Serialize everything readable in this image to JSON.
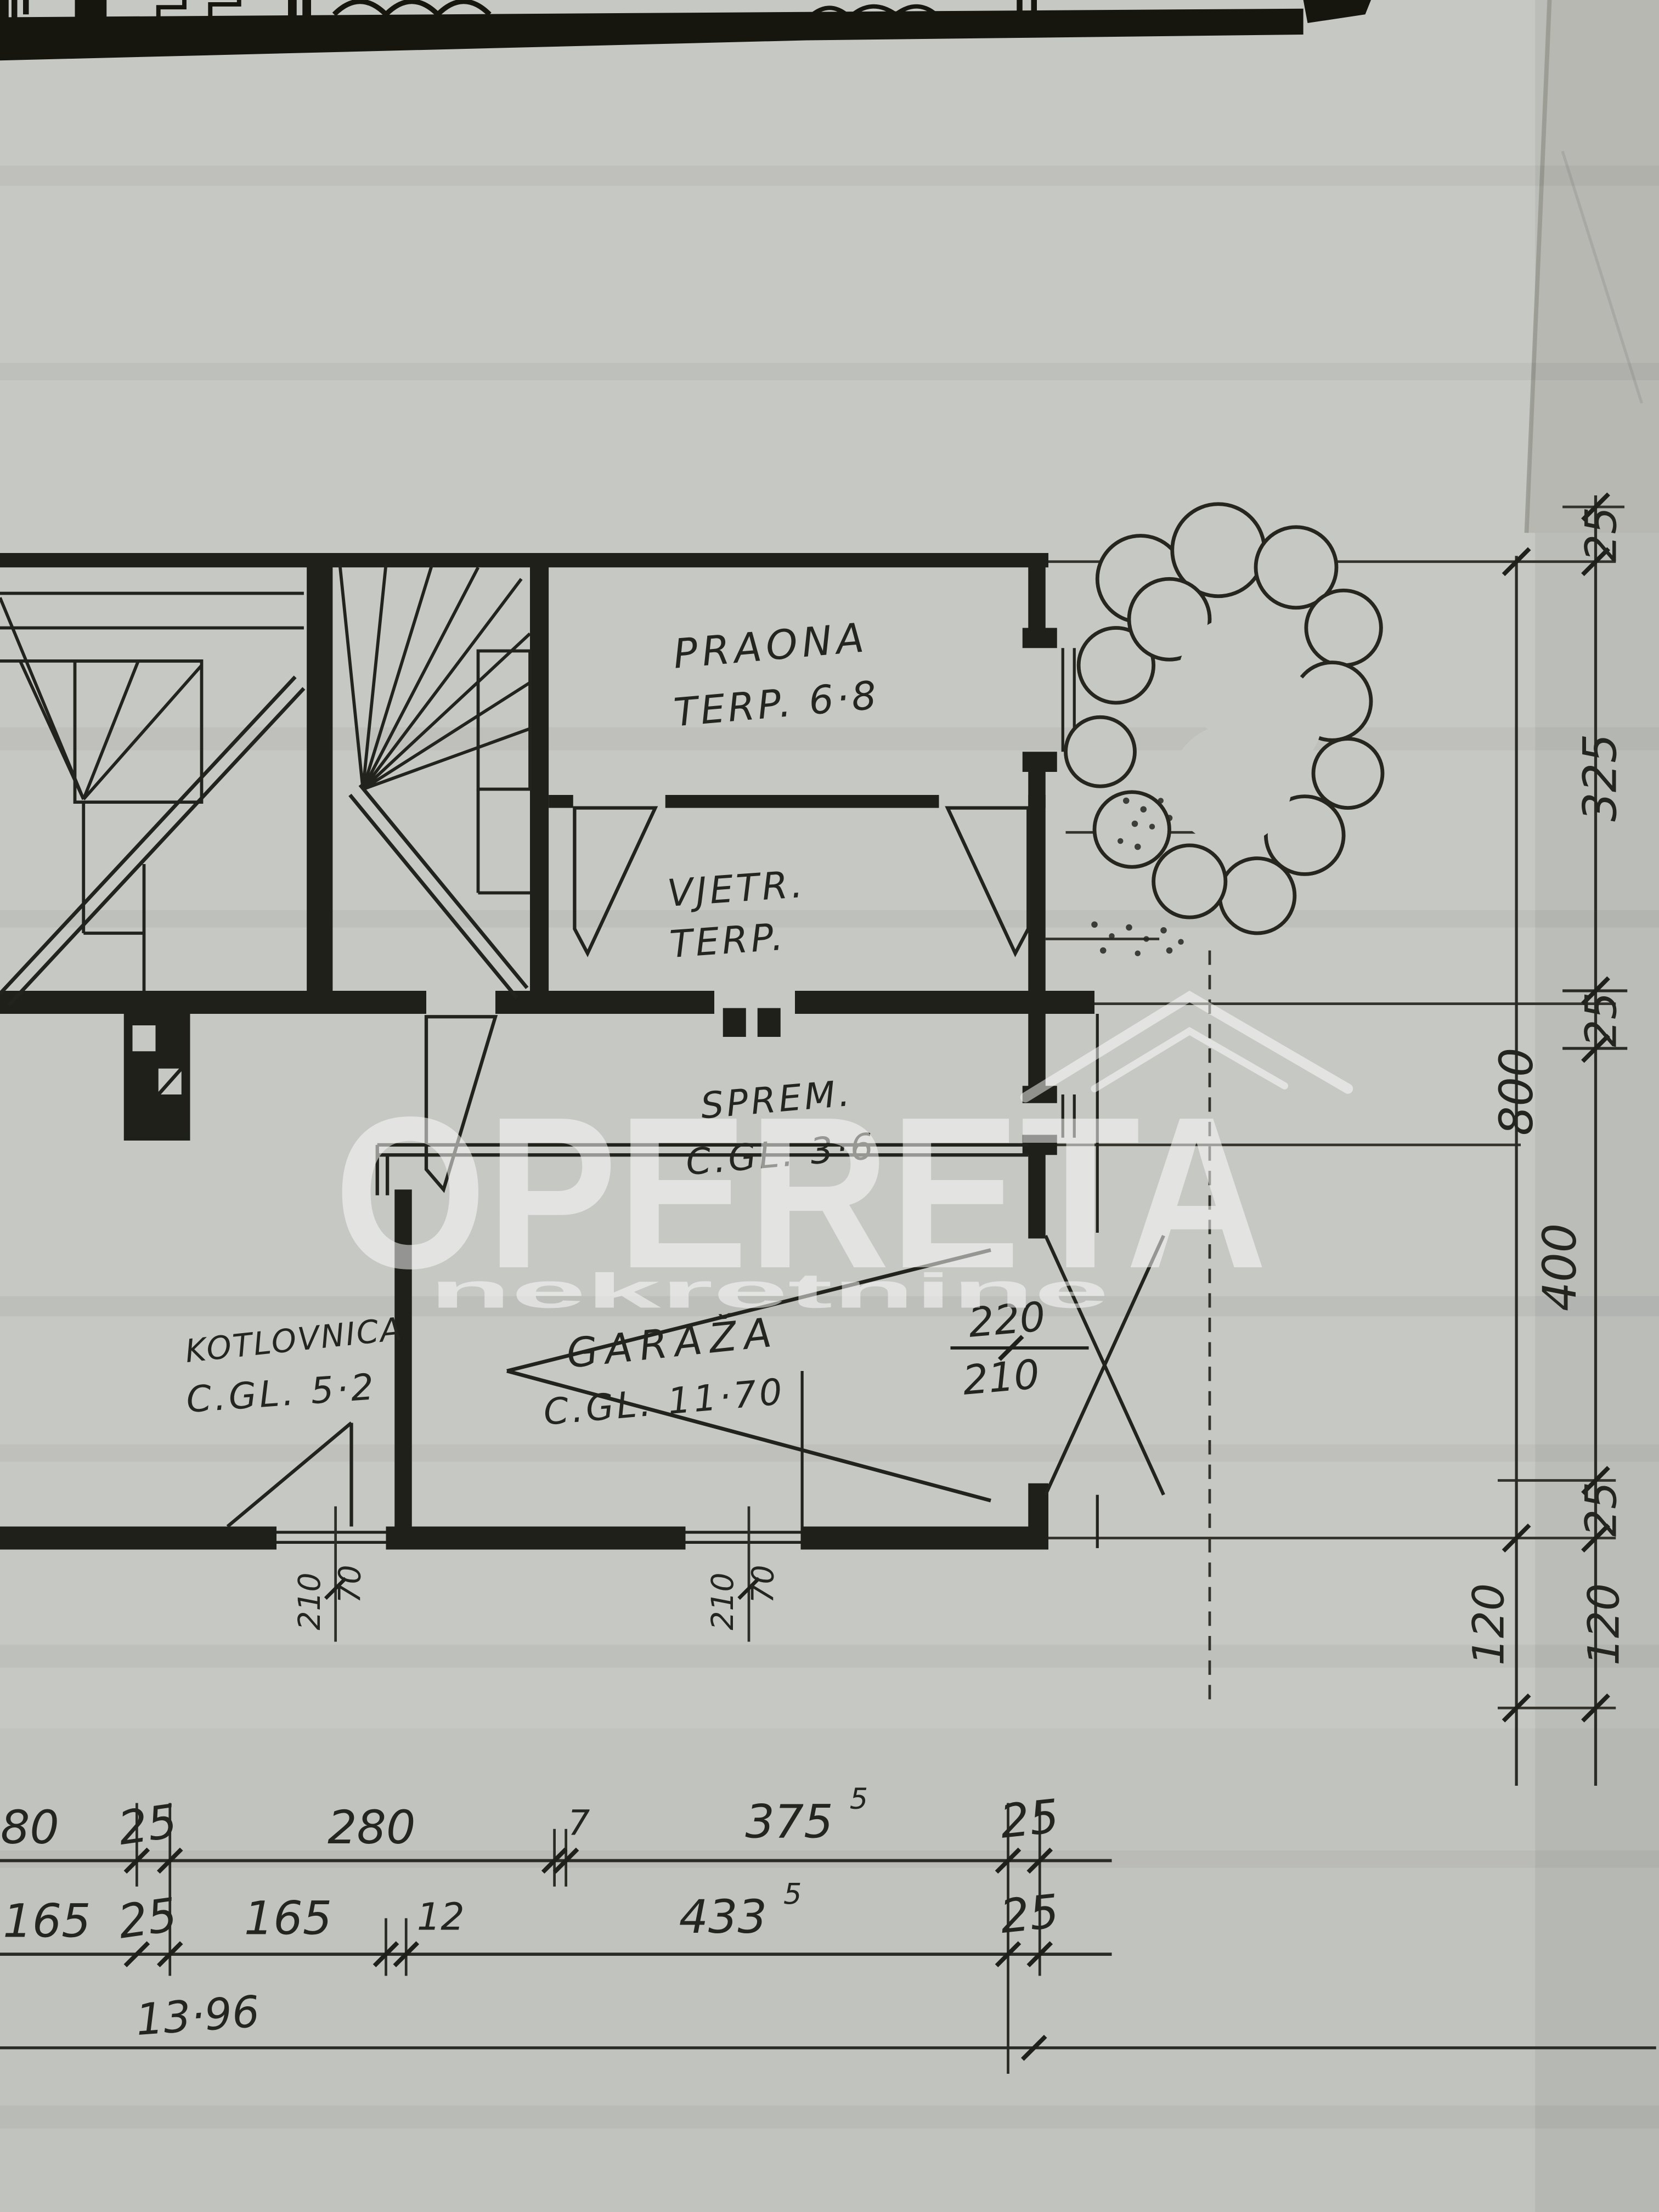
{
  "photo": {
    "type": "scanned floor plan photograph",
    "paper_color": "#c6c8c3",
    "ink_color": "#20201b",
    "watermark_color": "#ffffff"
  },
  "watermark": {
    "brand": "OPERETA",
    "tagline": "nekretnine"
  },
  "rooms": {
    "praona": {
      "name": "PRAONA",
      "detail": "TERP. 6·8"
    },
    "vjetrobran": {
      "name": "VJETR.",
      "detail": "TERP."
    },
    "sprema": {
      "name": "SPREM.",
      "detail": "C.GL. 3·6"
    },
    "kotlovnica": {
      "name": "KOTLOVNICA",
      "detail": "C.GL. 5·2"
    },
    "garaza": {
      "name": "GARAŽA",
      "detail": "C.GL. 11·70"
    }
  },
  "openings": {
    "garage_door": {
      "width": "220",
      "height": "210"
    },
    "window_left": {
      "width": "210",
      "height": "70"
    },
    "window_mid": {
      "width": "210",
      "height": "70"
    }
  },
  "dimensions": {
    "right_inner": [
      "25",
      "325",
      "25",
      "400",
      "25",
      "120"
    ],
    "right_outer": [
      "800",
      "120"
    ],
    "bottom_row1": [
      "280",
      "25",
      "280",
      "7",
      "375",
      "25"
    ],
    "bottom_row1_sup": "5",
    "bottom_row2": [
      "165",
      "25",
      "165",
      "12",
      "433",
      "25"
    ],
    "bottom_row2_sup": "5",
    "total_width": "13·96"
  }
}
